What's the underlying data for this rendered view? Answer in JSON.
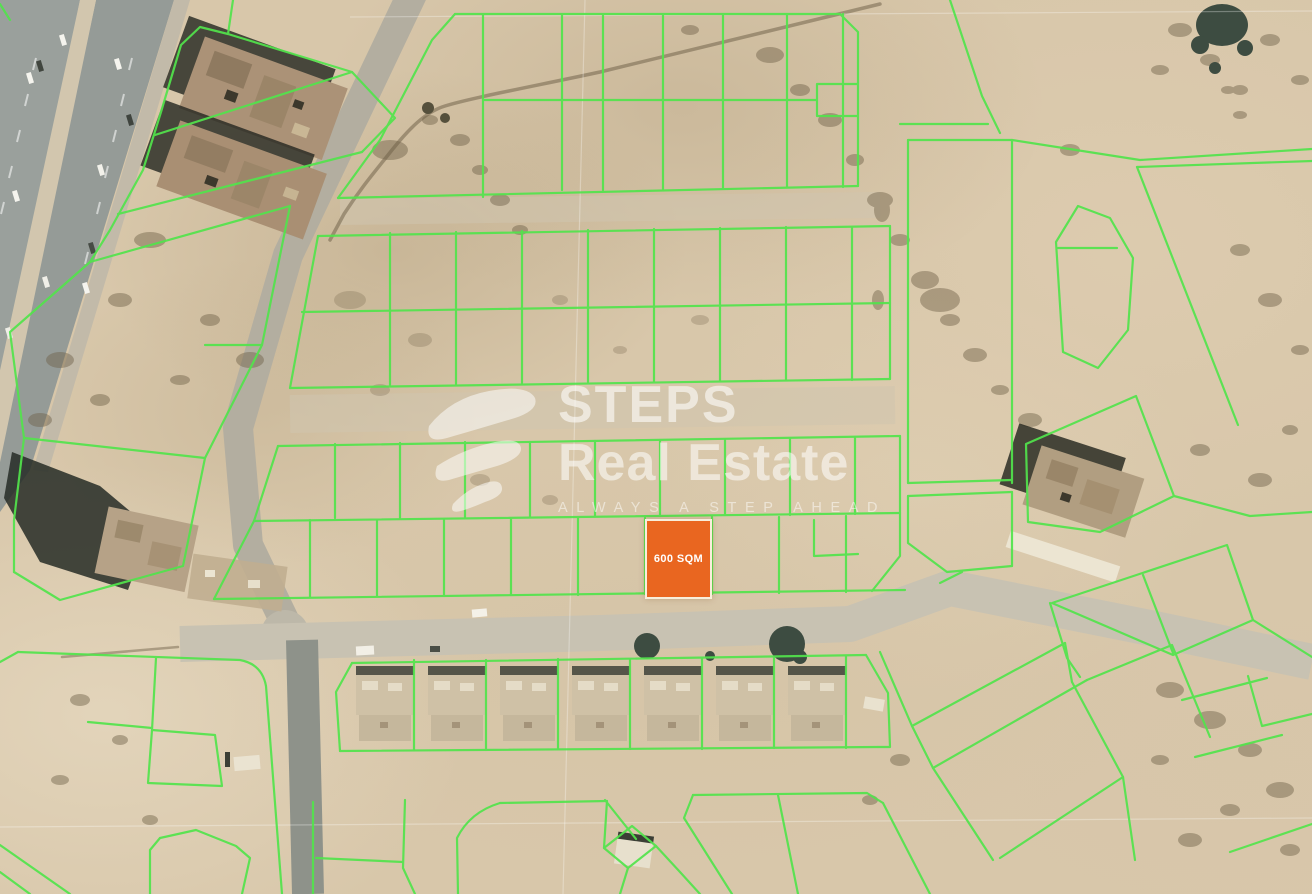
{
  "page": {
    "type": "satellite-map-listing-image",
    "width_px": 1312,
    "height_px": 894
  },
  "map": {
    "description": "Aerial satellite view of desert land subdivisions with plot boundaries overlaid in bright green",
    "terrain": "desert sand with scattered scrub, dirt tracks, a multi-lane highway at top-left and a row of villas at bottom center",
    "colors": {
      "sand": "#d8c7aa",
      "plot_boundary": "#52e44c",
      "road": "#b3aea0",
      "highway": "#9a9f9b"
    },
    "highlighted_plot": {
      "label": "600 SQM",
      "fill": "#e96620",
      "border": "#f8eedb",
      "text_color": "#ffffff"
    }
  },
  "watermark": {
    "logo_icon": "steps-brush-s-logo",
    "brand_line1": "STEPS",
    "brand_line2": "Real Estate",
    "tagline": "ALWAYS A STEP AHEAD",
    "color": "#ffffff"
  }
}
